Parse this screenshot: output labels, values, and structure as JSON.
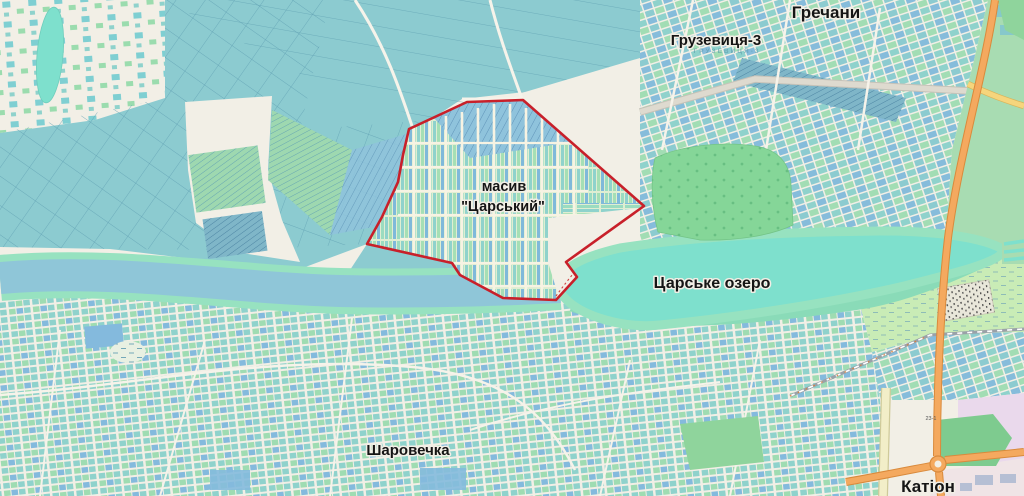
{
  "labels": {
    "grechany": "Гречани",
    "gruzevytsia3": "Грузевиця-3",
    "gruzevytsia3_area": "ГРУЗЕВИЦЯ-3",
    "masyv_line1": "масив",
    "masyv_line2": "\"Царський\"",
    "tsarske_ozero": "Царське озеро",
    "sharovechka": "Шаровечка",
    "kation": "Катіон",
    "road_ref": "23-1"
  },
  "highlight": {
    "name": "boundary of masyv Tsarskyi",
    "color": "#c8202a"
  },
  "palette": {
    "background": "#f2efe6",
    "fields_teal": "#8ccbd0",
    "plots_green": "#9fdcb2",
    "plots_blue": "#84badd",
    "lake_water": "#7ee0cd",
    "river_water": "#8fc6d8",
    "shore_green": "#97e2c0",
    "orchard_green": "#85d698",
    "grass_green": "#c9ecb6",
    "road_orange": "#f4a95f",
    "road_yellow": "#f6d57c",
    "industrial_pink": "#ead9ec",
    "railway_grey": "#9aa1a8",
    "outline_red": "#c8202a"
  }
}
